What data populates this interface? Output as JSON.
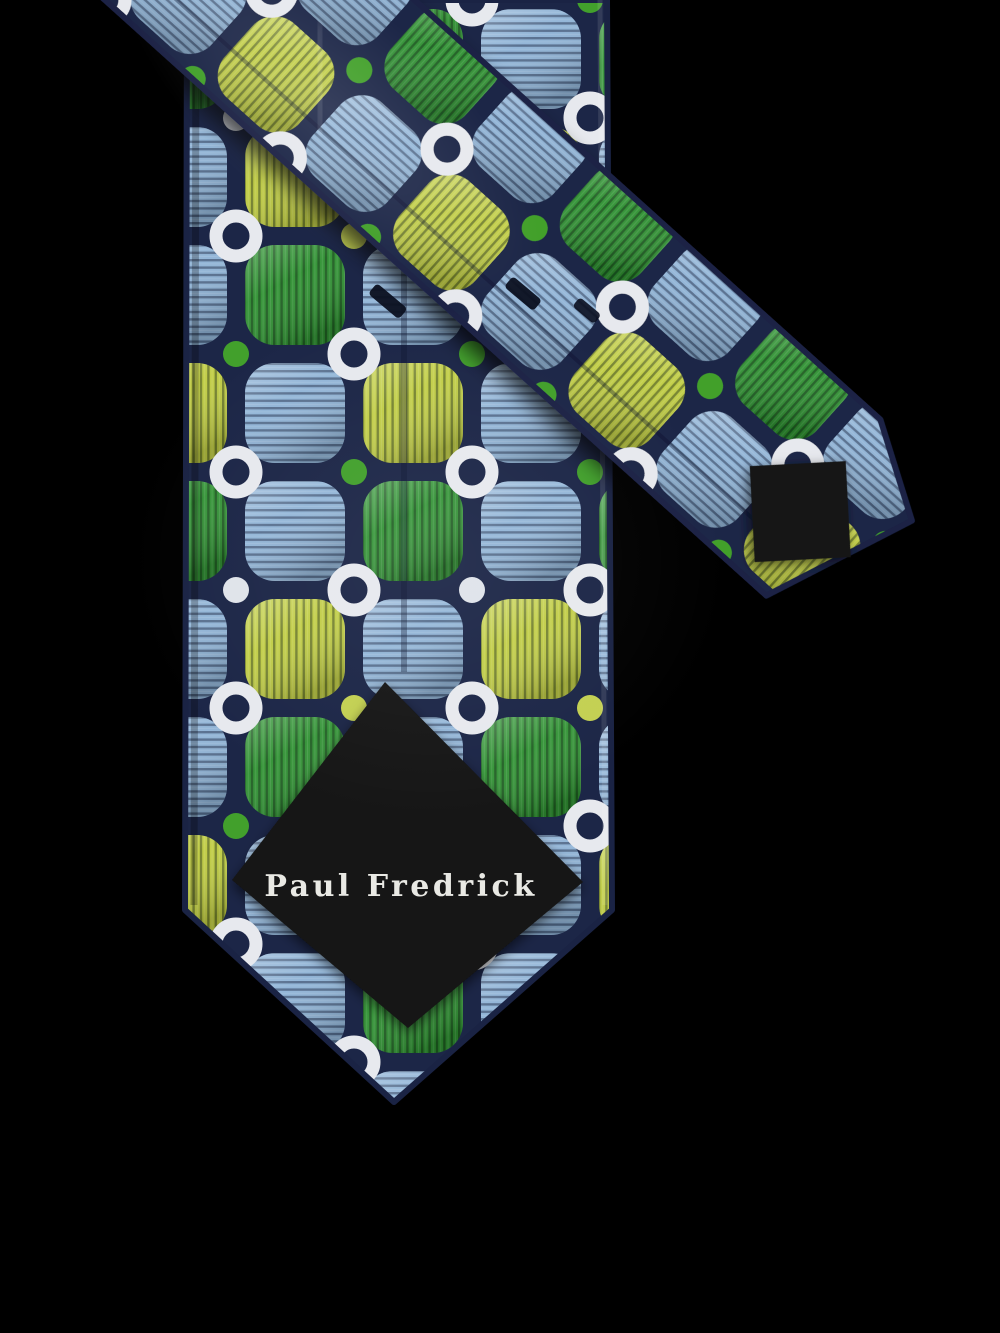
{
  "product": {
    "brand_label": "Paul Fredrick",
    "label_text_color": "#e9e9e4",
    "lining_color": "#141414",
    "background_color": "#000000",
    "fabric": {
      "ground": "#1c2647",
      "trim": "#1a2344",
      "seam": "#0c142e",
      "squares": {
        "blue": "#8fb3d6",
        "green": "#2f9132",
        "chartreuse": "#bfcc41"
      },
      "ring": "#e7e9ee",
      "dots": {
        "green": "#42a02c",
        "chartreuse": "#c3d052",
        "white": "#dfe3ea"
      }
    }
  }
}
